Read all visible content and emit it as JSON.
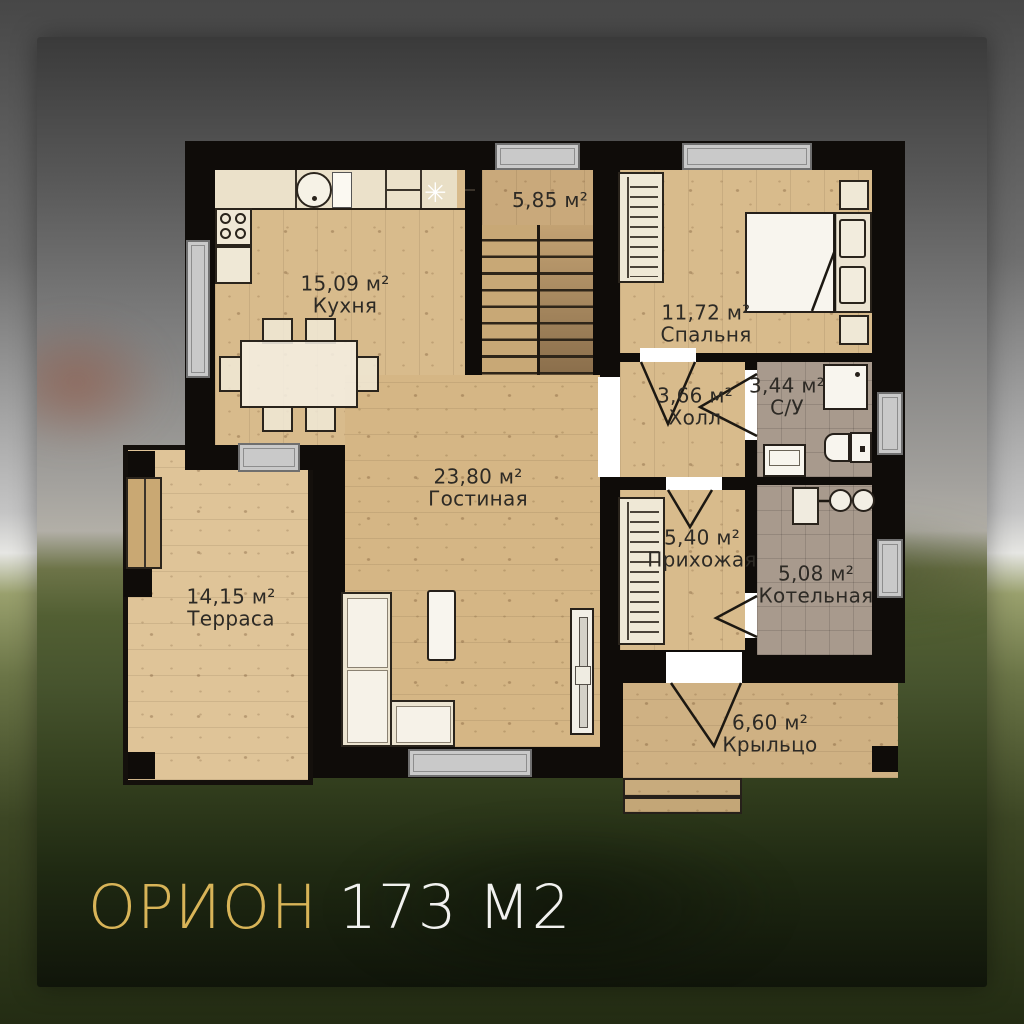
{
  "title": {
    "name": "ОРИОН",
    "area": "173 М2"
  },
  "rooms": {
    "stairs": {
      "area": "5,85 м²"
    },
    "kitchen": {
      "area": "15,09 м²",
      "name": "Кухня"
    },
    "bedroom": {
      "area": "11,72 м²",
      "name": "Спальня"
    },
    "hall": {
      "area": "3,66 м²",
      "name": "Холл"
    },
    "bathroom": {
      "area": "3,44 м²",
      "name": "С/У"
    },
    "living": {
      "area": "23,80 м²",
      "name": "Гостиная"
    },
    "entry": {
      "area": "5,40 м²",
      "name": "Прихожая"
    },
    "boiler": {
      "area": "5,08 м²",
      "name": "Котельная"
    },
    "terrace": {
      "area": "14,15 м²",
      "name": "Терраса"
    },
    "porch": {
      "area": "6,60 м²",
      "name": "Крыльцо"
    }
  },
  "icons": {
    "fridge_snowflake": "✳"
  },
  "colors": {
    "accent_gold": "#d8b458",
    "wall": "#0f0c09",
    "wood": "#d8bb8c",
    "tile": "#a89a8d"
  }
}
